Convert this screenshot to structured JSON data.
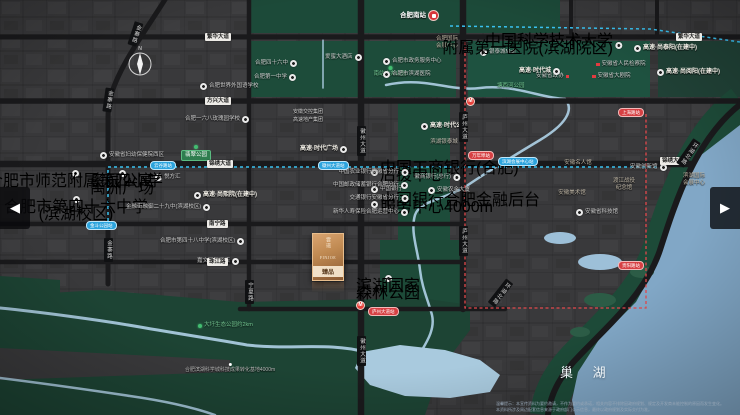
{
  "lake": {
    "label": "巢 湖"
  },
  "compass": {
    "label": "N"
  },
  "arrows": {
    "left": "◀",
    "right": "▶"
  },
  "logo": {
    "vertical": "雲璟",
    "latin": "FINJOE",
    "seal": "臻品"
  },
  "disclaimer": [
    "温馨提示：本宣传资料为要约邀请，不作为要约或承诺，相关内容不排除因政府规划、规定及开发商未能控制的原因而发生变化。",
    "本资料所涉及周边配套信息来源于政府部门公示信息，最终以政府规划及实际交付为准。"
  ],
  "labels": [
    {
      "k": "train",
      "x": 400,
      "y": 10,
      "t": "合肥南站",
      "i": "r",
      "nm": "railway-station-label"
    },
    {
      "k": "green",
      "x": 390,
      "y": 66,
      "t": "南站中央公园",
      "i": "t",
      "a": "c"
    },
    {
      "k": "green",
      "x": 497,
      "y": 83,
      "t": "塘西河公园"
    },
    {
      "k": "poi",
      "x": 255,
      "y": 60,
      "t": "合肥四十六中",
      "i": "r"
    },
    {
      "k": "poi",
      "x": 254,
      "y": 74,
      "t": "合肥第一中学",
      "i": "r"
    },
    {
      "k": "poi",
      "x": 325,
      "y": 54,
      "t": "爱蜜大酒店",
      "i": "r"
    },
    {
      "k": "poi",
      "x": 200,
      "y": 83,
      "t": "合肥世界外国语学校",
      "i": "l"
    },
    {
      "k": "poi",
      "x": 185,
      "y": 116,
      "t": "合肥一六八玫瑰园学校",
      "i": "r"
    },
    {
      "k": "poi",
      "x": 383,
      "y": 58,
      "t": "合肥市政务服务中心",
      "i": "l"
    },
    {
      "k": "poi",
      "x": 383,
      "y": 71,
      "t": "合肥市滨湖医院",
      "i": "l"
    },
    {
      "k": "landmark",
      "x": 447,
      "y": 36,
      "l": [
        "合肥国际",
        "会展中心"
      ],
      "a": "c"
    },
    {
      "k": "poi",
      "x": 480,
      "y": 49,
      "t": "银泰城Mall",
      "i": "l"
    },
    {
      "k": "poi2",
      "x": 622,
      "y": 38,
      "l": [
        "中国科学技术大学",
        "附属第一医院(滨湖院区)"
      ],
      "a": "r",
      "i": "r"
    },
    {
      "k": "project",
      "x": 634,
      "y": 45,
      "t": "高速·尚泰阳(在建中)",
      "i": "l"
    },
    {
      "k": "project",
      "x": 657,
      "y": 69,
      "t": "高速·尚阅阳(在建中)",
      "i": "l"
    },
    {
      "k": "reddot",
      "x": 596,
      "y": 61,
      "t": "安徽省人民检察院",
      "i": "l"
    },
    {
      "k": "reddot",
      "x": 536,
      "y": 73,
      "t": "安徽省政协",
      "i": "r"
    },
    {
      "k": "reddot",
      "x": 592,
      "y": 73,
      "t": "安徽省大剧院",
      "i": "l"
    },
    {
      "k": "project",
      "x": 519,
      "y": 68,
      "t": "高速·时代城",
      "i": "r"
    },
    {
      "k": "brand-green",
      "x": 293,
      "y": 109,
      "t": "安徽交控集团"
    },
    {
      "k": "brand-gold",
      "x": 293,
      "y": 117,
      "t": "高速地产集团"
    },
    {
      "k": "project",
      "x": 300,
      "y": 146,
      "t": "高速·时代广场",
      "i": "r"
    },
    {
      "k": "project",
      "x": 421,
      "y": 123,
      "t": "高速·时代公园",
      "i": "l"
    },
    {
      "k": "landmark-red",
      "x": 444,
      "y": 139,
      "l": [
        "滨湖银泰城"
      ],
      "a": "c"
    },
    {
      "k": "poi",
      "x": 100,
      "y": 152,
      "t": "安徽省妇幼保健院西区",
      "i": "l"
    },
    {
      "k": "greenbox",
      "x": 196,
      "y": 145,
      "t": "翡翠公园",
      "i": "t",
      "a": "c"
    },
    {
      "k": "poi2",
      "x": 122,
      "y": 170,
      "l": [
        "奥园公寓",
        "禹洲广场"
      ],
      "a": "c",
      "i": "t"
    },
    {
      "k": "poi",
      "x": 155,
      "y": 174,
      "t": "悦方汇",
      "i": "l"
    },
    {
      "k": "poi2",
      "x": 75,
      "y": 170,
      "l": [
        "合肥市师范附属第四小学"
      ],
      "a": "c",
      "i": "t"
    },
    {
      "k": "poi2",
      "x": 76,
      "y": 196,
      "l": [
        "合肥市第四十六中学",
        "(滨湖校区)"
      ],
      "a": "c",
      "i": "t"
    },
    {
      "k": "project",
      "x": 194,
      "y": 192,
      "t": "高速·尚熙院(在建中)",
      "i": "l"
    },
    {
      "k": "poi",
      "x": 126,
      "y": 204,
      "t": "金融街融御二十九中(滨湖校区)",
      "i": "r"
    },
    {
      "k": "poi",
      "x": 160,
      "y": 238,
      "t": "合肥市第四十八中学(滨湖校区)",
      "i": "r"
    },
    {
      "k": "poi",
      "x": 197,
      "y": 258,
      "t": "嘉文国际酒店",
      "i": "r"
    },
    {
      "k": "poi2",
      "x": 388,
      "y": 275,
      "l": [
        "滨湖国家",
        "森林公园"
      ],
      "a": "c",
      "i": "t"
    },
    {
      "k": "poi2",
      "x": 371,
      "y": 165,
      "l": [
        "中国工商银行(合肥)",
        "后援中心"
      ],
      "i": "l"
    },
    {
      "k": "poi",
      "x": 371,
      "y": 186,
      "t": "中国银行",
      "i": "l"
    },
    {
      "k": "poi2",
      "x": 371,
      "y": 197,
      "l": [
        "中国银行合肥金融后台",
        "服务中心4000m"
      ],
      "i": "l"
    },
    {
      "k": "poi",
      "x": 408,
      "y": 169,
      "t": "中国农业银行安徽省分行",
      "i": "r",
      "a": "r"
    },
    {
      "k": "poi",
      "x": 408,
      "y": 182,
      "t": "中国邮政储蓄银行合肥分行",
      "i": "r",
      "a": "r"
    },
    {
      "k": "poi",
      "x": 408,
      "y": 195,
      "t": "交通银行安徽省分行",
      "i": "r",
      "a": "r"
    },
    {
      "k": "poi",
      "x": 408,
      "y": 209,
      "t": "新华人寿保险合肥运营中心",
      "i": "r",
      "a": "r"
    },
    {
      "k": "poi",
      "x": 460,
      "y": 174,
      "t": "徽商银行(总行)",
      "i": "r",
      "a": "r"
    },
    {
      "k": "poi",
      "x": 428,
      "y": 187,
      "t": "安徽农金大厦",
      "i": "l"
    },
    {
      "k": "landmark",
      "x": 578,
      "y": 160,
      "l": [
        "安徽名人馆"
      ],
      "a": "c"
    },
    {
      "k": "landmark",
      "x": 624,
      "y": 178,
      "l": [
        "渡江战役",
        "纪念馆"
      ],
      "a": "c"
    },
    {
      "k": "landmark",
      "x": 572,
      "y": 190,
      "l": [
        "安徽美术馆"
      ],
      "a": "c"
    },
    {
      "k": "poi",
      "x": 576,
      "y": 209,
      "t": "安徽省科技馆",
      "i": "l"
    },
    {
      "k": "poi",
      "x": 630,
      "y": 164,
      "t": "安徽创新馆",
      "i": "r"
    },
    {
      "k": "landmark",
      "x": 694,
      "y": 173,
      "l": [
        "滨湖国际",
        "会展中心"
      ],
      "a": "c"
    },
    {
      "k": "tiny",
      "x": 230,
      "y": 363,
      "t": "合肥滨湖科学城科技成果转化基地4000m",
      "a": "c",
      "i": "t"
    },
    {
      "k": "green",
      "x": 198,
      "y": 322,
      "t": "大圩生态公园约2km",
      "i": "l"
    },
    {
      "k": "roadh",
      "x": 205,
      "y": 33,
      "t": "繁华大道"
    },
    {
      "k": "roadh",
      "x": 676,
      "y": 33,
      "t": "繁华大道"
    },
    {
      "k": "roadh",
      "x": 205,
      "y": 97,
      "t": "方兴大道"
    },
    {
      "k": "roadh",
      "x": 207,
      "y": 160,
      "t": "锦绣大道"
    },
    {
      "k": "roadh",
      "x": 660,
      "y": 157,
      "t": "锦绣大道"
    },
    {
      "k": "roadh",
      "x": 207,
      "y": 220,
      "t": "南宁路"
    },
    {
      "k": "roadh",
      "x": 207,
      "y": 258,
      "t": "珠江路"
    },
    {
      "k": "roadv",
      "x": 131,
      "y": 22,
      "t": "金寨路",
      "rot": 18
    },
    {
      "k": "roadv",
      "x": 104,
      "y": 88,
      "t": "金寨路",
      "rot": 8
    },
    {
      "k": "roadv",
      "x": 104,
      "y": 238,
      "t": "金寨路"
    },
    {
      "k": "roadv",
      "x": 245,
      "y": 280,
      "t": "宁夏路"
    },
    {
      "k": "roadv",
      "x": 357,
      "y": 126,
      "t": "徽州大道"
    },
    {
      "k": "roadv",
      "x": 357,
      "y": 336,
      "t": "徽州大道"
    },
    {
      "k": "roadv",
      "x": 459,
      "y": 112,
      "t": "庐州大道"
    },
    {
      "k": "roadv",
      "x": 459,
      "y": 226,
      "t": "庐州大道"
    },
    {
      "k": "roadv",
      "x": 496,
      "y": 278,
      "t": "环湖北路",
      "rot": 38
    },
    {
      "k": "roadv",
      "x": 684,
      "y": 138,
      "t": "环湖北路",
      "rot": 35
    },
    {
      "k": "pillb",
      "x": 150,
      "y": 161,
      "t": "云谷路站"
    },
    {
      "k": "pillb",
      "x": 318,
      "y": 161,
      "t": "徽州大道站"
    },
    {
      "k": "pillb",
      "x": 498,
      "y": 157,
      "t": "滨湖会展中心站"
    },
    {
      "k": "pillb",
      "x": 86,
      "y": 221,
      "t": "金斗公园站"
    },
    {
      "k": "pillr",
      "x": 468,
      "y": 151,
      "t": "万年埠站"
    },
    {
      "k": "pillr",
      "x": 618,
      "y": 108,
      "t": "上海路站"
    },
    {
      "k": "pillr",
      "x": 618,
      "y": 261,
      "t": "贵阳路站"
    },
    {
      "k": "pillr",
      "x": 368,
      "y": 307,
      "t": "庐州大道站"
    },
    {
      "k": "badge",
      "x": 466,
      "y": 97,
      "t": "M"
    },
    {
      "k": "badge",
      "x": 356,
      "y": 301,
      "t": "M"
    }
  ]
}
